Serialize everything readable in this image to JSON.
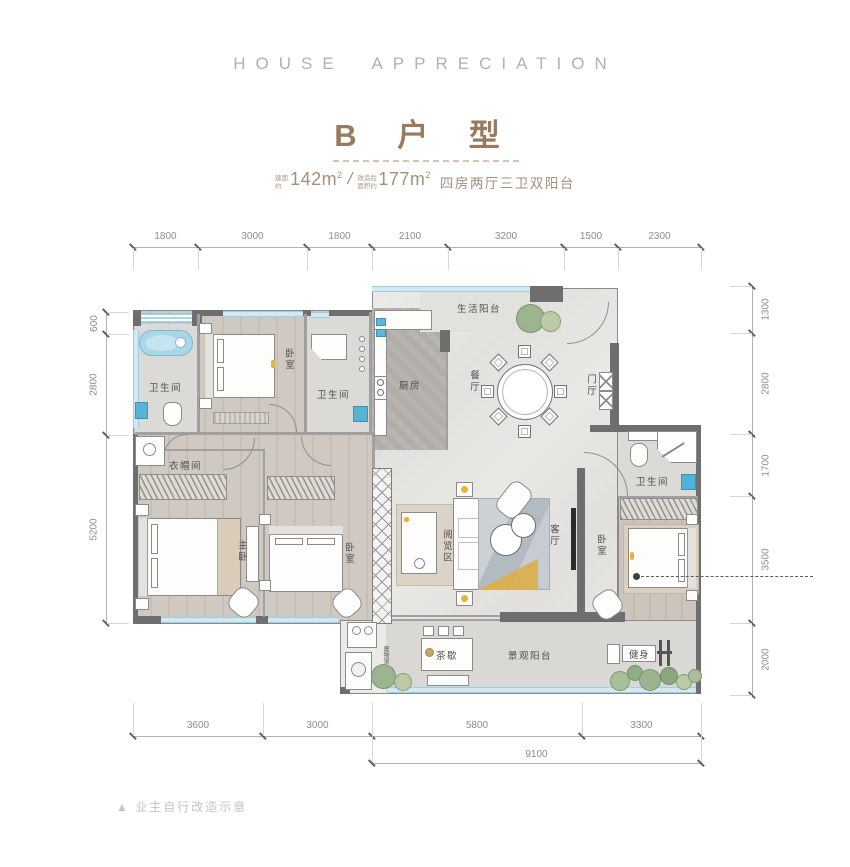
{
  "header": {
    "eyebrow": "HOUSE APPRECIATION",
    "title": "B 户 型",
    "subtitle": {
      "label1": "建面约",
      "value1": "142m",
      "sup1": "2",
      "separator": "/",
      "label2": "改造后面积约",
      "value2": "177m",
      "sup2": "2",
      "layout": "四房两厅三卫双阳台"
    }
  },
  "dims": {
    "top": [
      "1800",
      "3000",
      "1800",
      "2100",
      "3200",
      "1500",
      "2300"
    ],
    "left": [
      "600",
      "2800",
      "5200"
    ],
    "right": [
      "1300",
      "2800",
      "1700",
      "3500",
      "2000"
    ],
    "bottom": [
      "3600",
      "3000",
      "5800",
      "3300"
    ],
    "total": "9100"
  },
  "rooms": {
    "bath1": "卫生间",
    "bedroom1": "卧室",
    "bath2": "卫生间",
    "kitchen": "厨房",
    "life_balcony": "生活阳台",
    "dining": "餐厅",
    "foyer": "门厅",
    "cloakroom": "衣帽间",
    "master_bedroom": "主卧",
    "bedroom2": "卧室",
    "reading_area": "阅览区",
    "living_room": "客厅",
    "bath3": "卫生间",
    "bedroom3": "卧室",
    "tea_break": "茶歇",
    "view_balcony": "景观阳台",
    "fitness": "健身",
    "rack": "置物架"
  },
  "footer": {
    "note": "▲ 业主自行改造示意"
  },
  "colors": {
    "accent_brown": "#9a7a5e",
    "window_blue": "#a9d6e7",
    "wall_gray": "#6e6e6e",
    "plant_green": "#9cb48d",
    "accent_yellow": "#e8b33c",
    "fixture_blue": "#57b4d5"
  }
}
